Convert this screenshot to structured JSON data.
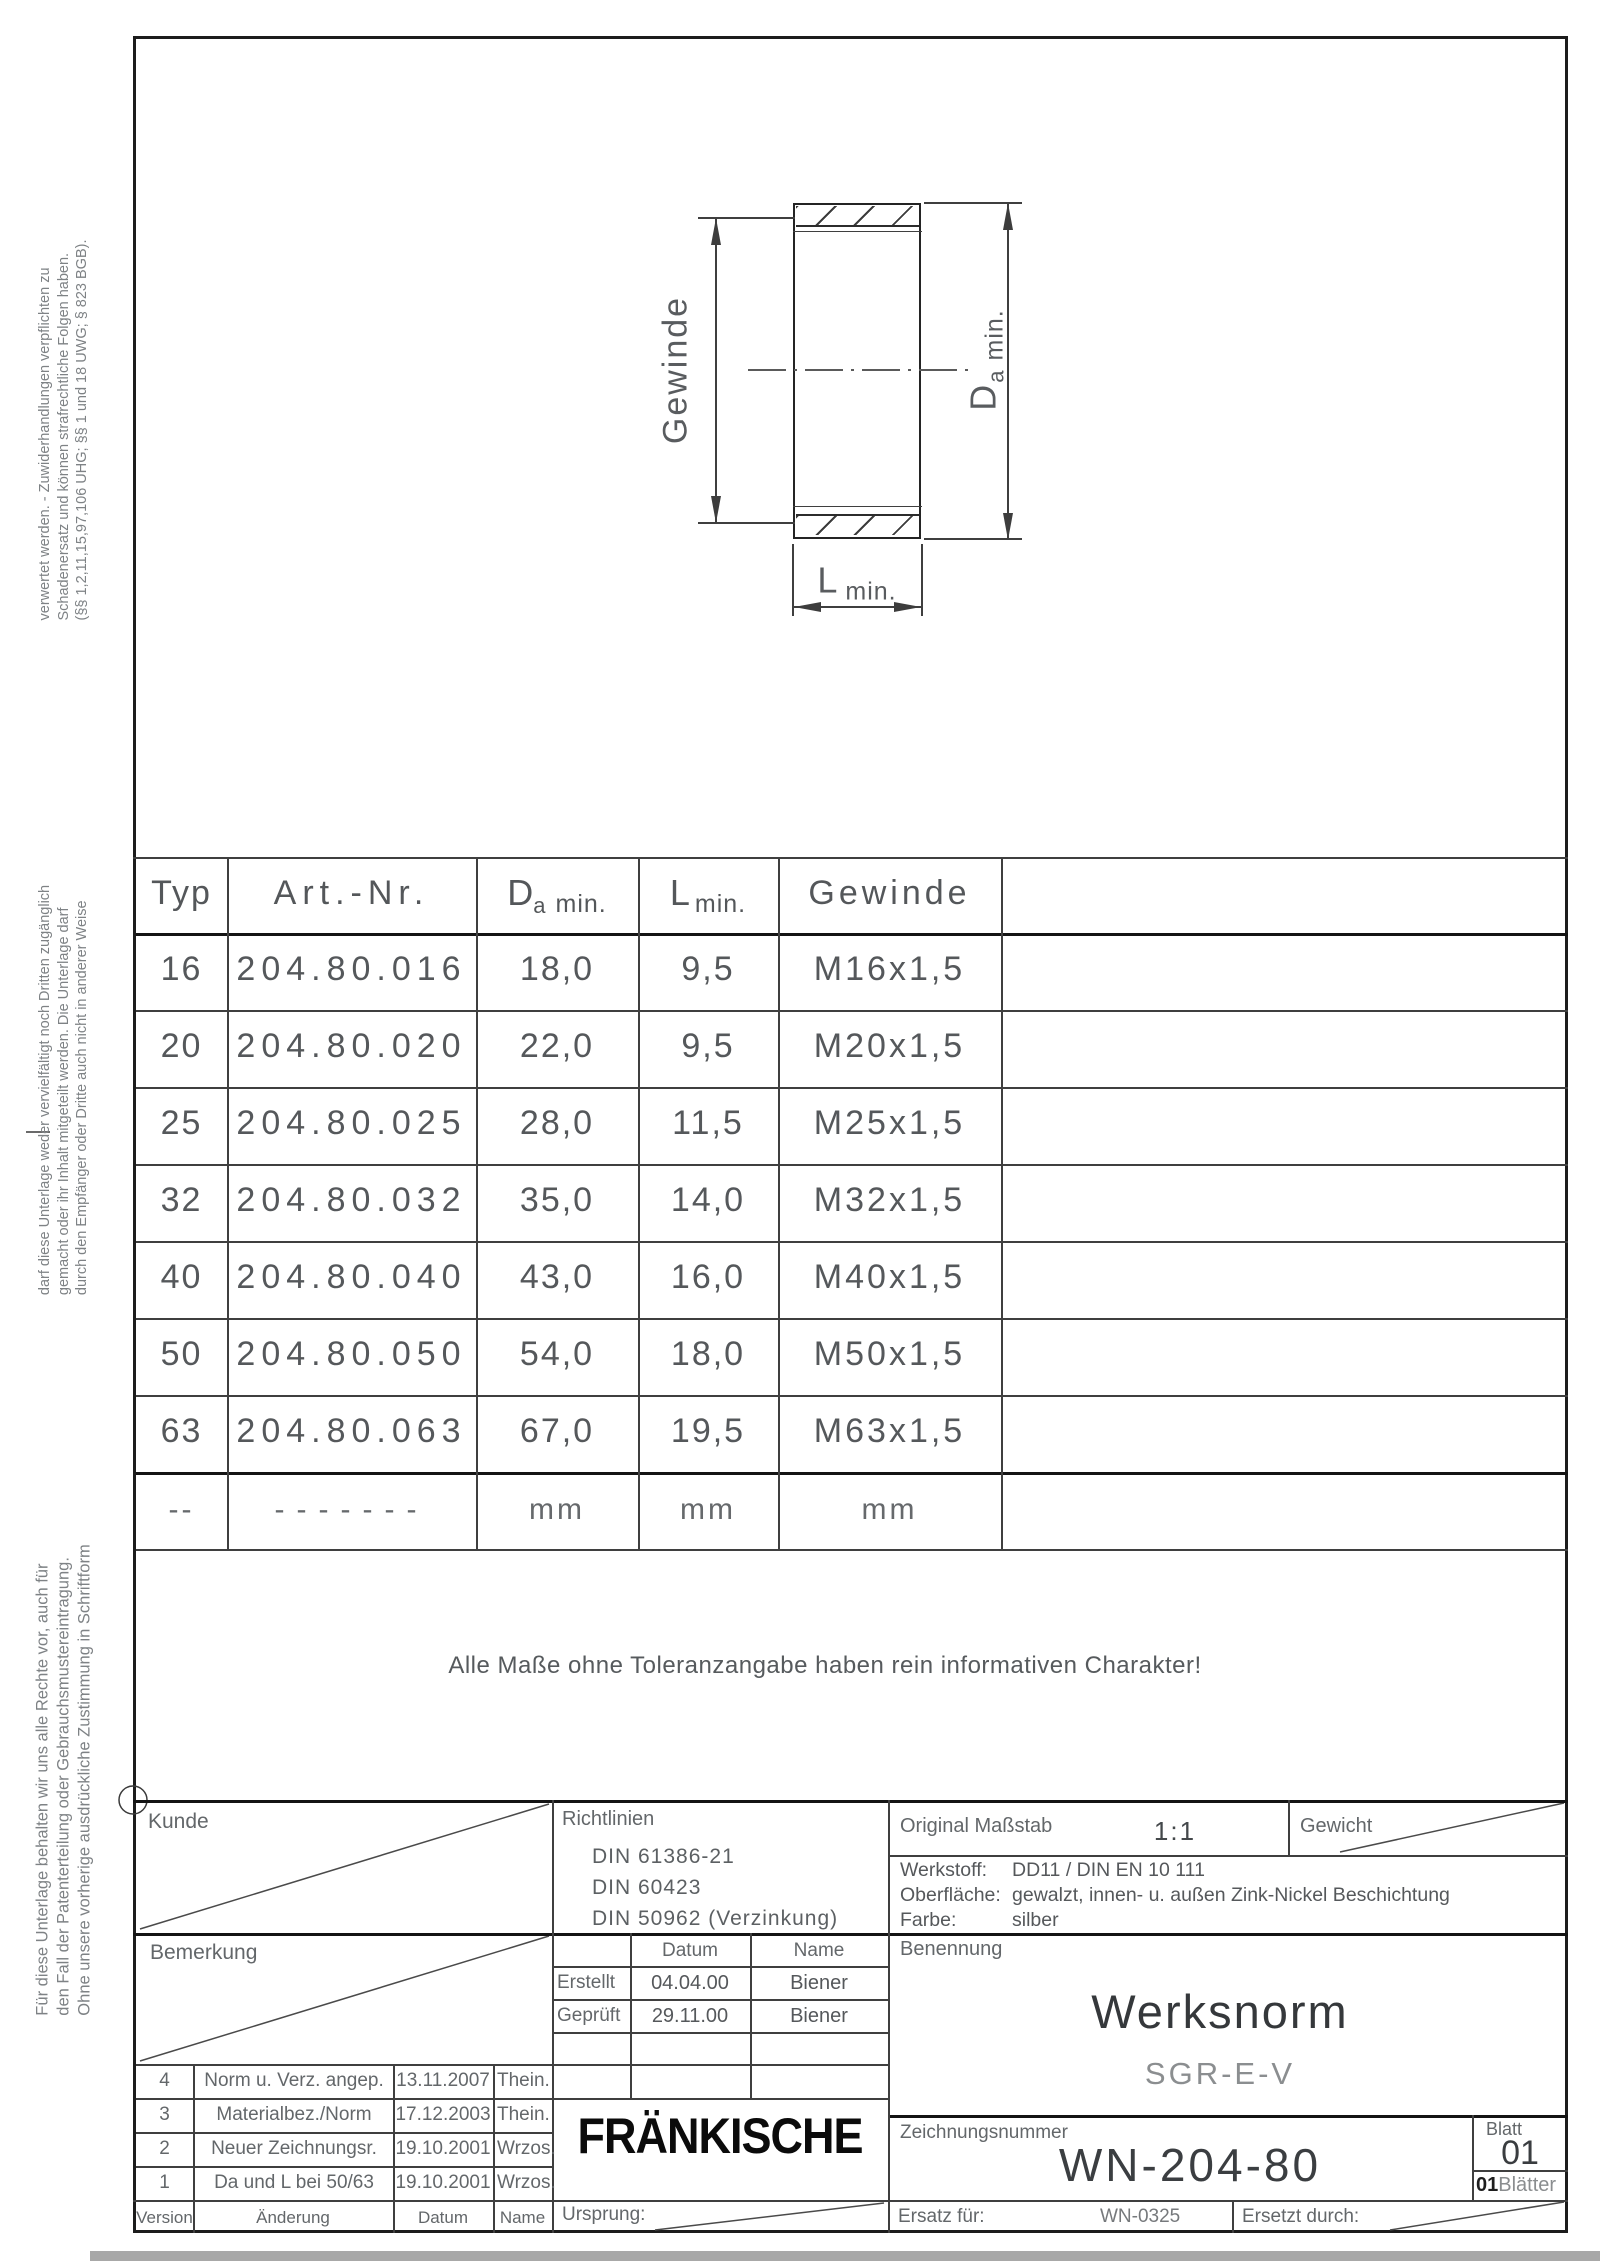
{
  "margin_notes": {
    "top": [
      "verwertet werden. - Zuwiderhandlungen verpflichten zu",
      "Schadenersatz und können strafrechtliche Folgen haben.",
      "(§§ 1,2,11,15,97,106 UHG; §§ 1 und 18 UWG; § 823 BGB)."
    ],
    "middle": [
      "darf diese Unterlage weder vervielfältigt noch Dritten zugänglich",
      "gemacht oder ihr Inhalt mitgeteilt werden. Die Unterlage darf",
      "durch den Empfänger oder Dritte auch nicht in anderer Weise"
    ],
    "bottom": [
      "Für diese Unterlage behalten wir uns alle Rechte vor, auch für",
      "den Fall der Patenterteilung oder Gebrauchsmustereintragung.",
      "Ohne unsere vorherige ausdrückliche Zustimmung in Schriftform"
    ]
  },
  "drawing": {
    "gewinde_label": "Gewinde",
    "da_label_main": "D",
    "da_label_sub": "a",
    "da_label_min": "min.",
    "l_label_main": "L",
    "l_label_min": "min."
  },
  "note": "Alle Maße ohne Toleranzangabe haben rein informativen Charakter!",
  "table": {
    "header": {
      "typ": "Typ",
      "art": "Art.-Nr.",
      "da_main": "D",
      "da_sub": "a",
      "da_min": "min.",
      "l_main": "L",
      "l_min": "min.",
      "gewinde": "Gewinde"
    },
    "rows": [
      [
        "16",
        "204.80.016",
        "18,0",
        "9,5",
        "M16x1,5"
      ],
      [
        "20",
        "204.80.020",
        "22,0",
        "9,5",
        "M20x1,5"
      ],
      [
        "25",
        "204.80.025",
        "28,0",
        "11,5",
        "M25x1,5"
      ],
      [
        "32",
        "204.80.032",
        "35,0",
        "14,0",
        "M32x1,5"
      ],
      [
        "40",
        "204.80.040",
        "43,0",
        "16,0",
        "M40x1,5"
      ],
      [
        "50",
        "204.80.050",
        "54,0",
        "18,0",
        "M50x1,5"
      ],
      [
        "63",
        "204.80.063",
        "67,0",
        "19,5",
        "M63x1,5"
      ]
    ],
    "units": [
      "--",
      "-------",
      "mm",
      "mm",
      "mm"
    ]
  },
  "title_block": {
    "kunde_label": "Kunde",
    "bemerkung_label": "Bemerkung",
    "richtlinien_label": "Richtlinien",
    "richtlinien": [
      "DIN 61386-21",
      "DIN 60423",
      "DIN 50962 (Verzinkung)"
    ],
    "approval": {
      "datum_label": "Datum",
      "name_label": "Name",
      "rows": [
        {
          "label": "Erstellt",
          "datum": "04.04.00",
          "name": "Biener"
        },
        {
          "label": "Geprüft",
          "datum": "29.11.00",
          "name": "Biener"
        }
      ]
    },
    "massstab_label": "Original Maßstab",
    "massstab_value": "1:1",
    "gewicht_label": "Gewicht",
    "werkstoff_label": "Werkstoff:",
    "werkstoff_value": "DD11 / DIN EN 10 111",
    "oberflaeche_label": "Oberfläche:",
    "oberflaeche_value": "gewalzt, innen- u. außen Zink-Nickel Beschichtung",
    "farbe_label": "Farbe:",
    "farbe_value": "silber",
    "benennung_label": "Benennung",
    "title_main": "Werksnorm",
    "title_sub": "SGR-E-V",
    "zeichnungsnummer_label": "Zeichnungsnummer",
    "zeichnungsnummer": "WN-204-80",
    "blatt_label": "Blatt",
    "blatt_value": "01",
    "blaetter_count": "01",
    "blaetter_label": "Blätter",
    "ersatz_label": "Ersatz für:",
    "ersatz_value": "WN-0325",
    "ersetzt_label": "Ersetzt durch:",
    "ursprung_label": "Ursprung:",
    "logo": "FRÄNKISCHE",
    "revisions": [
      {
        "version": "4",
        "change": "Norm u. Verz. angep.",
        "date": "13.11.2007",
        "name": "Thein."
      },
      {
        "version": "3",
        "change": "Materialbez./Norm",
        "date": "17.12.2003",
        "name": "Thein."
      },
      {
        "version": "2",
        "change": "Neuer Zeichnungsr.",
        "date": "19.10.2001",
        "name": "Wrzos."
      },
      {
        "version": "1",
        "change": "Da und L bei 50/63",
        "date": "19.10.2001",
        "name": "Wrzos."
      }
    ],
    "footer": {
      "version": "Version",
      "aenderung": "Änderung",
      "datum": "Datum",
      "name": "Name"
    }
  }
}
